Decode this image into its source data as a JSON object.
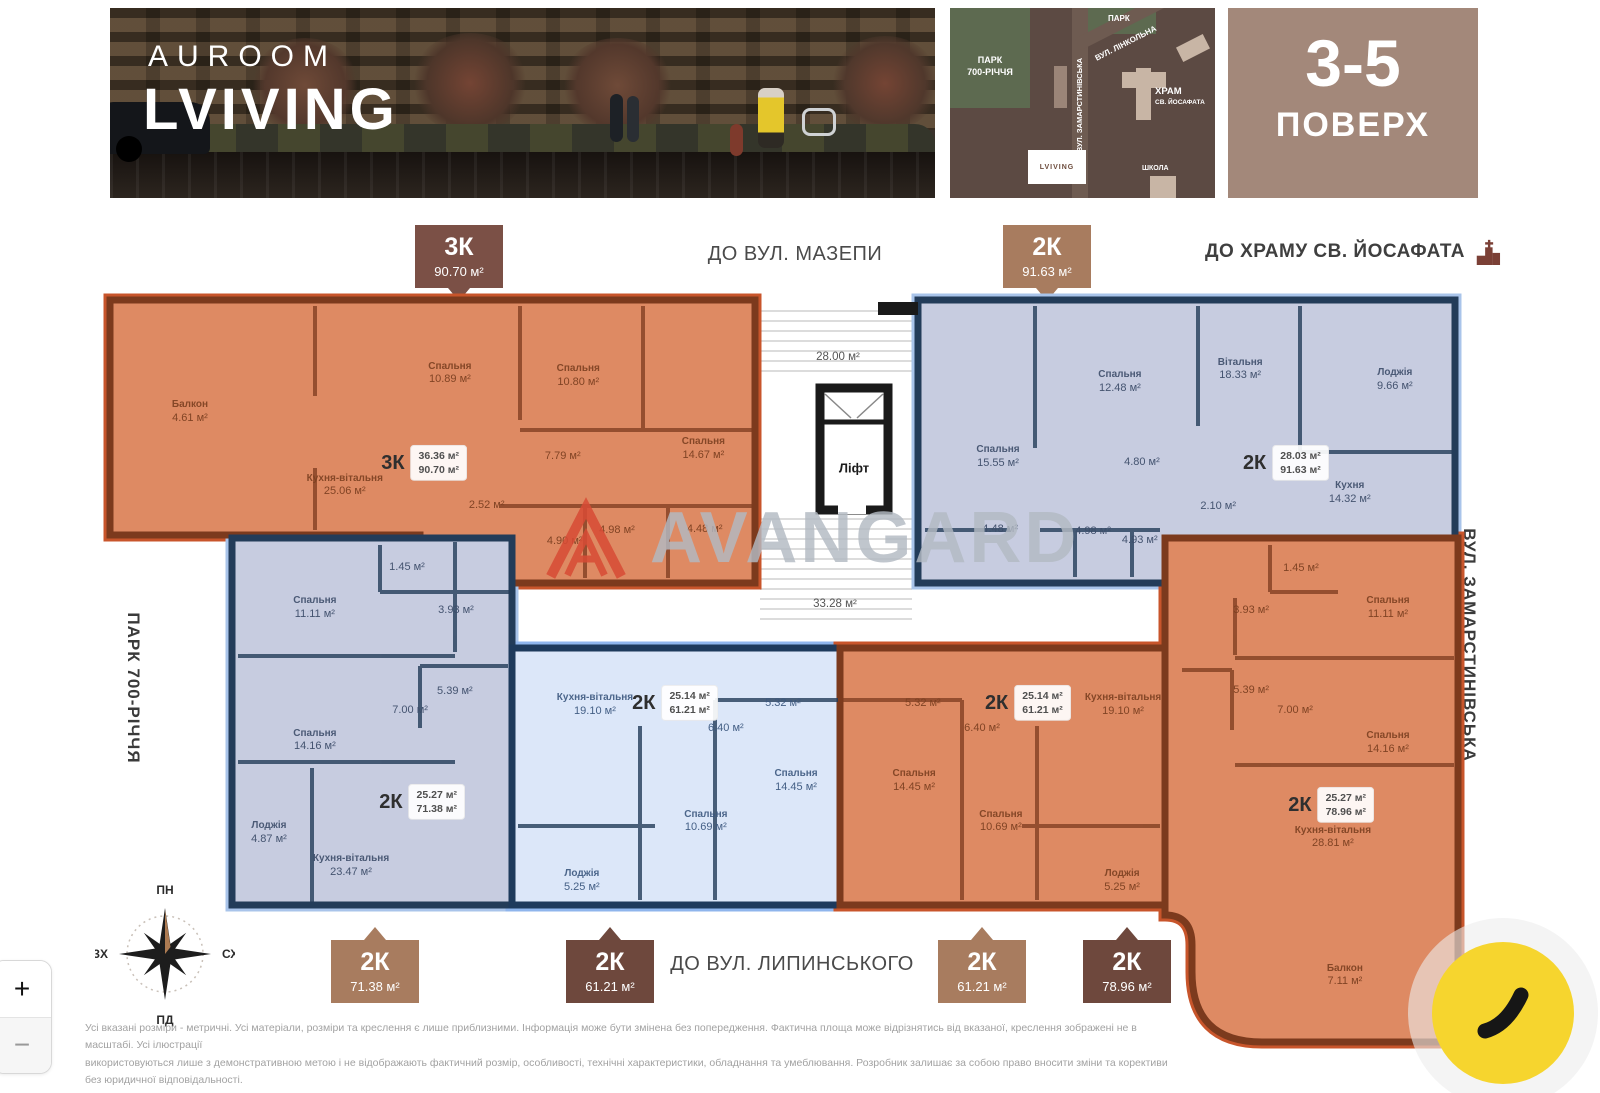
{
  "brand": {
    "line1": "AUROOM",
    "line2": "LVIVING"
  },
  "floor_panel": {
    "range": "3-5",
    "label": "ПОВЕРХ"
  },
  "map": {
    "park_top": "ПАРК",
    "park_left_line1": "ПАРК",
    "park_left_line2": "700-РІЧЧЯ",
    "street_diagonal": "ВУЛ. ЛІНКОЛЬНА",
    "street_vertical": "ВУЛ. ЗАМАРСТИНІВСЬКА",
    "church_line1": "ХРАМ",
    "church_line2": "СВ. ЙОСАФАТА",
    "school": "ШКОЛА",
    "logo": "LVIVING"
  },
  "directions": {
    "top": "ДО ВУЛ. МАЗЕПИ",
    "church": "ДО ХРАМУ СВ. ЙОСАФАТА",
    "bottom": "ДО ВУЛ. ЛИПИНСЬКОГО"
  },
  "side_labels": {
    "left": "ПАРК 700-РІЧЧЯ",
    "right": "ВУЛ. ЗАМАРСТИНІВСЬКА"
  },
  "badges": {
    "top": [
      {
        "type": "3К",
        "area": "90.70 м²"
      },
      {
        "type": "2К",
        "area": "91.63 м²"
      }
    ],
    "bottom": [
      {
        "type": "2К",
        "area": "71.38 м²"
      },
      {
        "type": "2К",
        "area": "61.21 м²"
      },
      {
        "type": "2К",
        "area": "61.21 м²"
      },
      {
        "type": "2К",
        "area": "78.96 м²"
      }
    ]
  },
  "common_areas": {
    "upper_hall": "28.00 м²",
    "lower_hall": "33.28 м²",
    "elevator": "Ліфт"
  },
  "compass": {
    "north": "ПН",
    "east": "СХ",
    "south": "ПД",
    "west": "ЗХ"
  },
  "watermark": "AVANGARD",
  "controls": {
    "zoom_in": "+",
    "zoom_out": "−"
  },
  "disclaimer": {
    "line1": "Усі вказані розміри - метричні. Усі матеріали, розміри та креслення є лише приблизними. Інформація може бути змінена без попередження. Фактична площа може відрізнятись від вказаної, креслення зображені не в масштабі. Усі ілюстрації",
    "line2": "використовуються лише з демонстративною метою і не відображають фактичний розмір, особливості, технічні характеристики, обладнання та умеблювання. Розробник залишає за собою право вносити зміни та корективи без юридичної відповідальності."
  },
  "apartments": [
    {
      "id": "apt-3k",
      "tone": "tone-orange",
      "label": {
        "type": "3К",
        "area_live": "36.36 м²",
        "area_total": "90.70 м²",
        "x": 48.7,
        "y": 57.6
      },
      "rooms": [
        {
          "name": "Балкон",
          "area": "4.61 м²",
          "x": 12.4,
          "y": 39.6
        },
        {
          "name": "Спальня",
          "area": "10.89 м²",
          "x": 52.7,
          "y": 26.1
        },
        {
          "name": "Спальня",
          "area": "10.80 м²",
          "x": 72.6,
          "y": 26.9
        },
        {
          "name": "Спальня",
          "area": "14.67 м²",
          "x": 92.0,
          "y": 52.7
        },
        {
          "name": "Кухня-вітальня",
          "area": "25.06 м²",
          "x": 36.4,
          "y": 65.7
        },
        {
          "area": "7.79 м²",
          "x": 70.2,
          "y": 55.5
        },
        {
          "area": "2.52 м²",
          "x": 58.4,
          "y": 72.8
        },
        {
          "area": "4.90 м²",
          "x": 70.5,
          "y": 85.5
        },
        {
          "area": "4.98 м²",
          "x": 78.6,
          "y": 81.6
        },
        {
          "area": "4.48 м²",
          "x": 92.2,
          "y": 81.3
        }
      ]
    },
    {
      "id": "apt-2k91",
      "tone": "tone-lavender",
      "label": {
        "type": "2К",
        "area_live": "28.03 м²",
        "area_total": "91.63 м²",
        "x": 68.5,
        "y": 57.6
      },
      "rooms": [
        {
          "name": "Спальня",
          "area": "15.55 м²",
          "x": 14.9,
          "y": 55.5
        },
        {
          "name": "Спальня",
          "area": "12.48 м²",
          "x": 37.6,
          "y": 29.0
        },
        {
          "name": "Вітальня",
          "area": "18.33 м²",
          "x": 60.0,
          "y": 24.7
        },
        {
          "name": "Лоджія",
          "area": "9.66 м²",
          "x": 88.8,
          "y": 28.3
        },
        {
          "name": "Кухня",
          "area": "14.32 м²",
          "x": 80.4,
          "y": 68.2
        },
        {
          "area": "4.80 м²",
          "x": 41.7,
          "y": 57.6
        },
        {
          "area": "2.10 м²",
          "x": 55.9,
          "y": 73.1
        },
        {
          "area": "4.48 м²",
          "x": 15.3,
          "y": 81.3
        },
        {
          "area": "4.98 м²",
          "x": 32.6,
          "y": 82.0
        },
        {
          "area": "4.93 м²",
          "x": 41.3,
          "y": 85.2
        }
      ]
    },
    {
      "id": "apt-2k71",
      "tone": "tone-lavender",
      "label": {
        "type": "2К",
        "area_live": "25.27 м²",
        "area_total": "71.38 м²",
        "x": 67.9,
        "y": 71.9
      },
      "rooms": [
        {
          "name": "Спальня",
          "area": "11.11 м²",
          "x": 29.6,
          "y": 19.1
        },
        {
          "area": "1.45 м²",
          "x": 62.5,
          "y": 8.2
        },
        {
          "area": "3.93 м²",
          "x": 80.0,
          "y": 19.9
        },
        {
          "name": "Спальня",
          "area": "14.16 м²",
          "x": 29.6,
          "y": 55.3
        },
        {
          "area": "7.00 м²",
          "x": 63.6,
          "y": 47.1
        },
        {
          "area": "5.39 м²",
          "x": 79.6,
          "y": 42.0
        },
        {
          "name": "Лоджія",
          "area": "4.87 м²",
          "x": 13.2,
          "y": 80.4
        },
        {
          "name": "Кухня-вітальня",
          "area": "23.47 м²",
          "x": 42.5,
          "y": 89.4
        }
      ]
    },
    {
      "id": "apt-2k61a",
      "tone": "tone-lightblue",
      "label": {
        "type": "2К",
        "area_live": "25.14 м²",
        "area_total": "61.21 м²",
        "x": 49.7,
        "y": 21.4
      },
      "rooms": [
        {
          "name": "Кухня-вітальня",
          "area": "19.10 м²",
          "x": 25.3,
          "y": 22.2
        },
        {
          "area": "5.32 м²",
          "x": 82.6,
          "y": 21.8
        },
        {
          "area": "6.40 м²",
          "x": 65.2,
          "y": 31.5
        },
        {
          "name": "Спальня",
          "area": "10.69 м²",
          "x": 59.1,
          "y": 67.7
        },
        {
          "name": "Спальня",
          "area": "14.45 м²",
          "x": 86.6,
          "y": 51.8
        },
        {
          "name": "Лоджія",
          "area": "5.25 м²",
          "x": 21.3,
          "y": 90.7
        }
      ]
    },
    {
      "id": "apt-2k61b",
      "tone": "tone-orange",
      "label": {
        "type": "2К",
        "area_live": "25.14 м²",
        "area_total": "61.21 м²",
        "x": 57.8,
        "y": 21.4
      },
      "rooms": [
        {
          "area": "5.32 м²",
          "x": 25.5,
          "y": 21.8
        },
        {
          "name": "Кухня-вітальня",
          "area": "19.10 м²",
          "x": 87.1,
          "y": 22.2
        },
        {
          "area": "6.40 м²",
          "x": 43.7,
          "y": 31.5
        },
        {
          "name": "Спальня",
          "area": "14.45 м²",
          "x": 22.8,
          "y": 51.8
        },
        {
          "name": "Спальня",
          "area": "10.69 м²",
          "x": 49.5,
          "y": 67.7
        },
        {
          "name": "Лоджія",
          "area": "5.25 м²",
          "x": 86.8,
          "y": 90.7
        }
      ]
    },
    {
      "id": "apt-2k79",
      "tone": "tone-orange",
      "label": {
        "type": "2К",
        "area_live": "25.27 м²",
        "area_total": "78.96 м²",
        "x": 56.7,
        "y": 53.0
      },
      "rooms": [
        {
          "area": "1.45 м²",
          "x": 46.4,
          "y": 6.2
        },
        {
          "area": "3.93 м²",
          "x": 29.4,
          "y": 14.5
        },
        {
          "name": "Спальня",
          "area": "11.11 м²",
          "x": 76.1,
          "y": 13.9
        },
        {
          "area": "5.39 м²",
          "x": 29.4,
          "y": 30.4
        },
        {
          "area": "7.00 м²",
          "x": 44.4,
          "y": 34.3
        },
        {
          "name": "Спальня",
          "area": "14.16 м²",
          "x": 76.1,
          "y": 40.7
        },
        {
          "name": "Кухня-вітальня",
          "area": "28.81 м²",
          "x": 57.3,
          "y": 59.5
        },
        {
          "name": "Балкон",
          "area": "7.11 м²",
          "x": 61.4,
          "y": 86.9
        }
      ]
    }
  ]
}
